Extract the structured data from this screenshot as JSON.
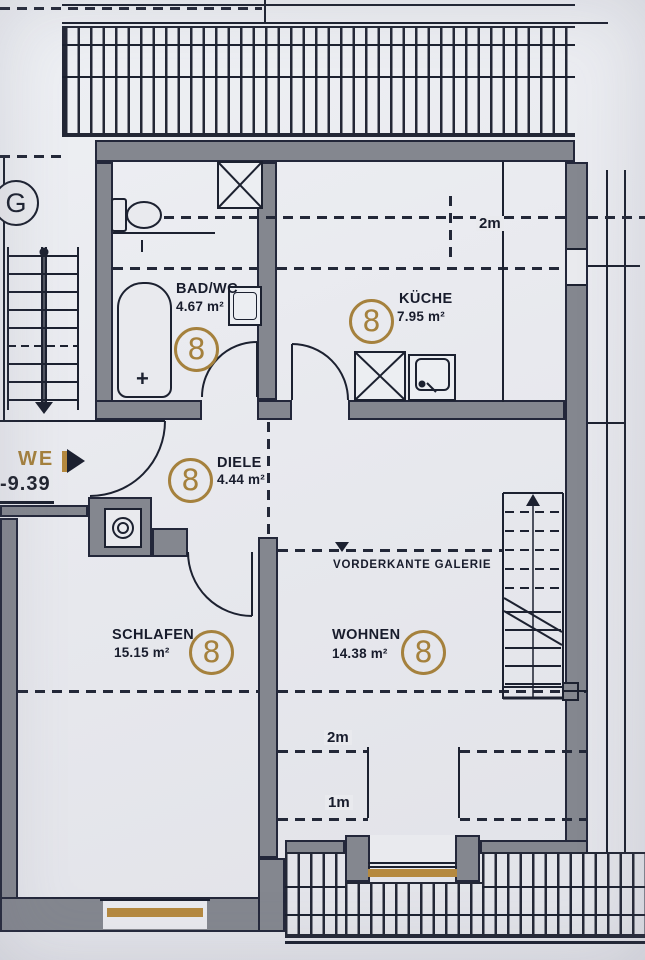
{
  "unit": {
    "label": "WE 8",
    "elevation": "-9.39"
  },
  "stairwell": {
    "label": "G"
  },
  "rooms": [
    {
      "id": "bad",
      "name": "BAD/WC",
      "area": "4.67 m²",
      "tag": "8"
    },
    {
      "id": "kueche",
      "name": "KÜCHE",
      "area": "7.95 m²",
      "tag": "8"
    },
    {
      "id": "diele",
      "name": "DIELE",
      "area": "4.44 m²",
      "tag": "8"
    },
    {
      "id": "schlafen",
      "name": "SCHLAFEN",
      "area": "15.15 m²",
      "tag": "8"
    },
    {
      "id": "wohnen",
      "name": "WOHNEN",
      "area": "14.38 m²",
      "tag": "8"
    }
  ],
  "annotations": {
    "galerie": "VORDERKANTE GALERIE",
    "knee_wall_top": "2m",
    "dormer_2m": "2m",
    "dormer_1m": "1m",
    "tub_drain": "+"
  },
  "colors": {
    "ink": "#1c2130",
    "wall": "#84878f",
    "paper": "#e9eaee",
    "gold": "#a5813d",
    "sill": "#b5893f"
  }
}
